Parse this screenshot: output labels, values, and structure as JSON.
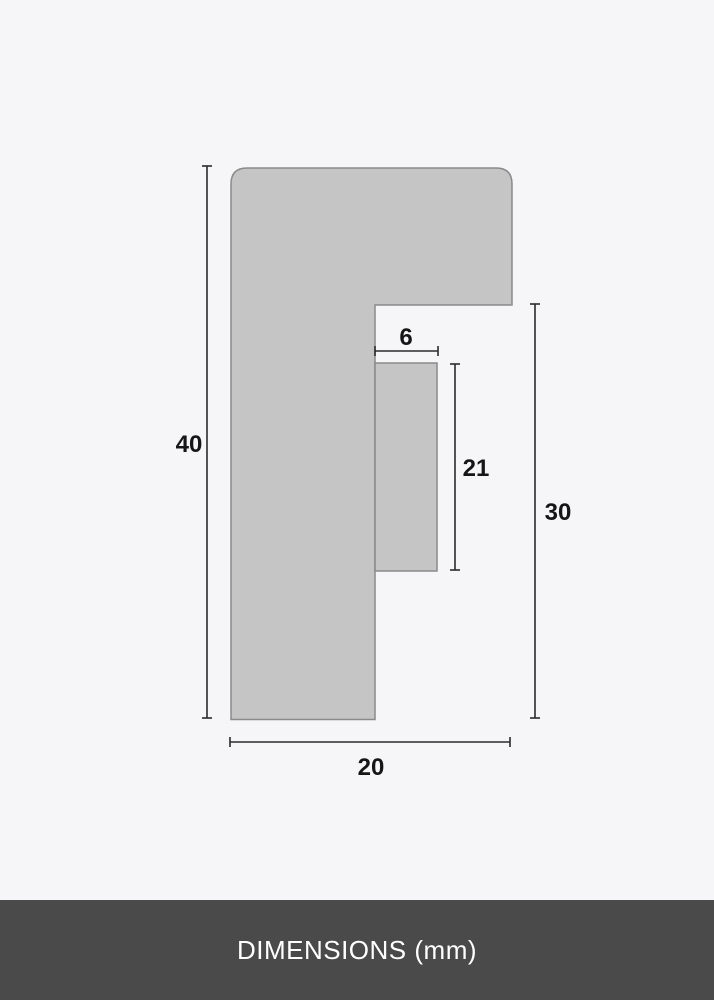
{
  "page": {
    "background_color": "#f6f6f8"
  },
  "diagram": {
    "type": "frame-profile-cross-section",
    "shape_fill_color": "#c6c5c5",
    "shape_stroke_color": "#8a8a8a",
    "dimension_line_color": "#2b2b2b",
    "label_color": "#161616",
    "dimensions": {
      "profile_height": "40",
      "profile_width": "20",
      "rabbet_width": "6",
      "rabbet_height": "21",
      "inner_height": "30"
    },
    "units": "mm"
  },
  "footer": {
    "label": "DIMENSIONS (mm)",
    "background_color": "#4b4a4a",
    "text_color": "#ffffff"
  }
}
